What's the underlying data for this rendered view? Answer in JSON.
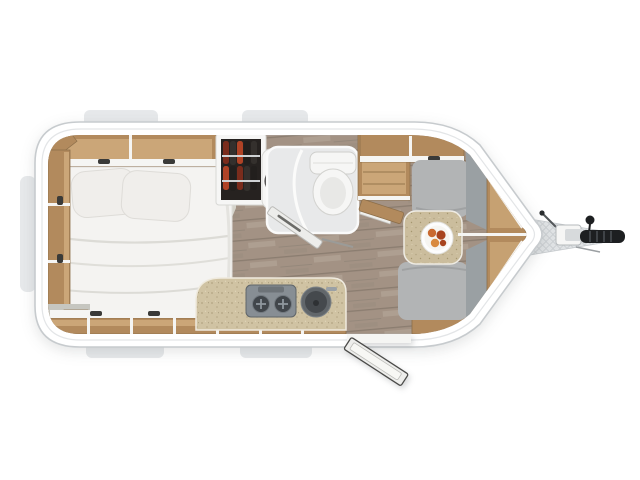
{
  "scene": {
    "kind": "caravan-floor-plan-top-view",
    "features": [
      "caravan-shell",
      "window-bump-top-left",
      "window-bump-top-mid",
      "window-bump-bottom-left",
      "window-bump-bottom-mid",
      "window-bump-left-side",
      "bedroom-carpet",
      "wood-floor",
      "overhead-cabinets-top",
      "side-shelves-left",
      "double-bed",
      "pillow-left",
      "pillow-right",
      "wardrobe-with-clothes",
      "vanity-sink",
      "bathroom-floor",
      "toilet",
      "bathroom-door",
      "tall-cabinet",
      "kitchen-counter",
      "stove-two-burner",
      "kitchen-sink",
      "bottom-cabinet-row",
      "entry-door-open",
      "dinette-table",
      "dinner-plate",
      "dinette-bench-top",
      "dinette-bench-bottom",
      "nose-backrests",
      "nose-shelves",
      "nose-window-panel-top",
      "nose-window-panel-bottom",
      "drawbar",
      "hitch-coupler",
      "hitch-handle",
      "jockey-knob"
    ]
  },
  "colors": {
    "background": "#ffffff",
    "shell": "#ffffff",
    "shellOutline": "#c7cbce",
    "shellSeam": "#e3e5e7",
    "tab": "#e7e9eb",
    "floorWood": "#a39284",
    "floorWoodDark": "#8b7d70",
    "floorWoodLight": "#b6a99b",
    "carpet": "#d5d3ca",
    "wallWood": "#b28a5d",
    "wallWoodDark": "#8d6f4a",
    "wallWoodLight": "#cba678",
    "trimWhite": "#f5f5f3",
    "bedding": "#f4f3f1",
    "pillow": "#f0eeeb",
    "bathFloor": "#e8e9ea",
    "fixtureWhite": "#f6f6f5",
    "vanityBasin": "#23201f",
    "counter": "#d0c3a3",
    "counterSpeckle": "#b3a583",
    "stoveBody": "#878e94",
    "burner": "#41464b",
    "sinkOuter": "#62676b",
    "sinkInner": "#45494d",
    "bench": "#b2b4b5",
    "benchBack": "#9aa0a3",
    "tableTop": "#cbbd9d",
    "plate": "#fdfdfd",
    "food1": "#c96a31",
    "food2": "#a8441f",
    "food3": "#d98a3e",
    "wardrobeInterior": "#262220",
    "clothes1": "#7a2c1c",
    "clothes2": "#b04326",
    "clothes3": "#34302d",
    "clothes4": "#221f1d",
    "nosePanel": "#6f747a",
    "nosePanelStripe": "#9aa1a8",
    "cornerCap": "#8d9296",
    "drawbar": "#e0e3e5",
    "drawbarHatch": "#c9cdd0",
    "hitchBlack": "#1d1f21",
    "doorLeaf": "#ededeb",
    "grayPatch": "#c6c6c0"
  }
}
